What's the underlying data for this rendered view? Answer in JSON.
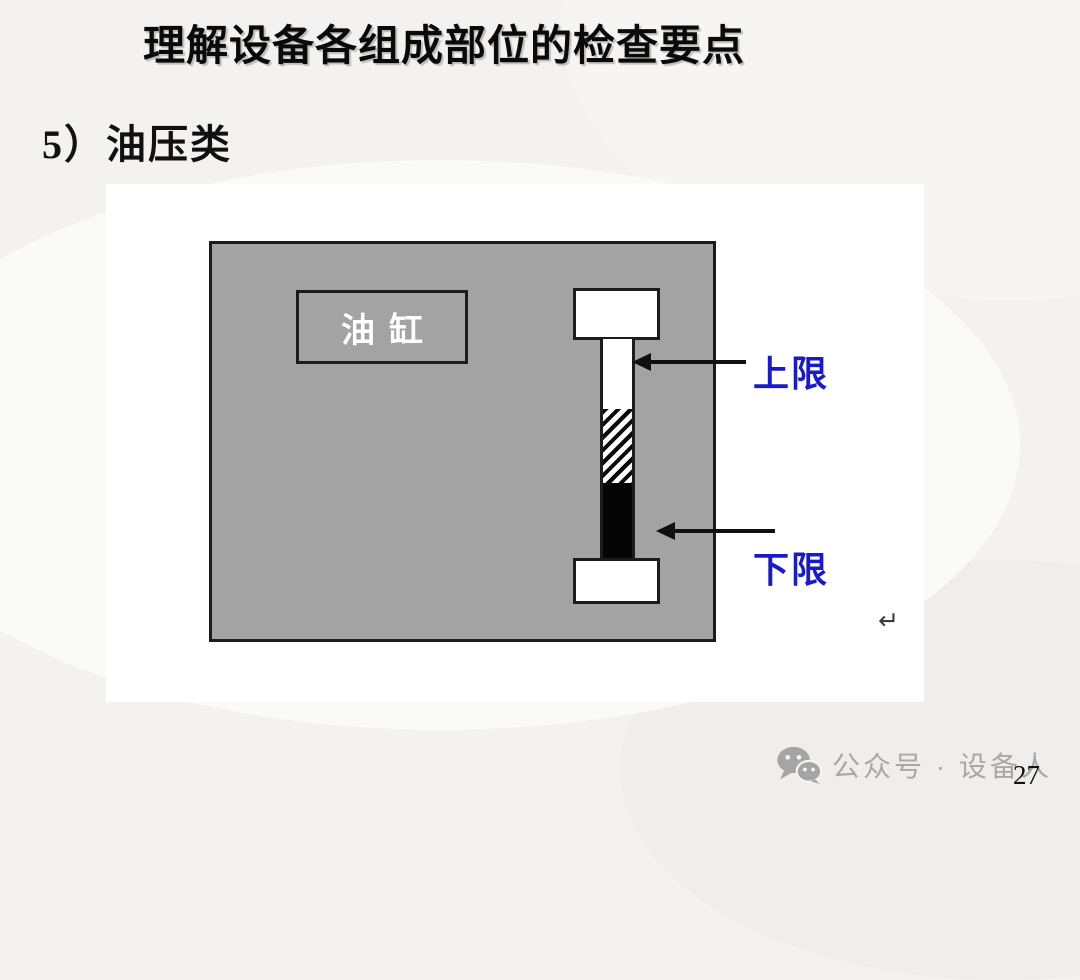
{
  "slide": {
    "title": "理解设备各组成部位的检查要点",
    "section_heading": "5）油压类",
    "diagram": {
      "tank_label": "油缸",
      "upper_limit_label": "上限",
      "lower_limit_label": "下限",
      "return_mark": "↵"
    },
    "footer": {
      "wechat_text": "公众号 · 设备人",
      "page_number": "27"
    },
    "colors": {
      "tank-gray": "#a3a3a3",
      "border-dark": "#1c1c1c",
      "limit-blue": "#1a1acd",
      "footer-gray": "#a8a8a8"
    }
  }
}
